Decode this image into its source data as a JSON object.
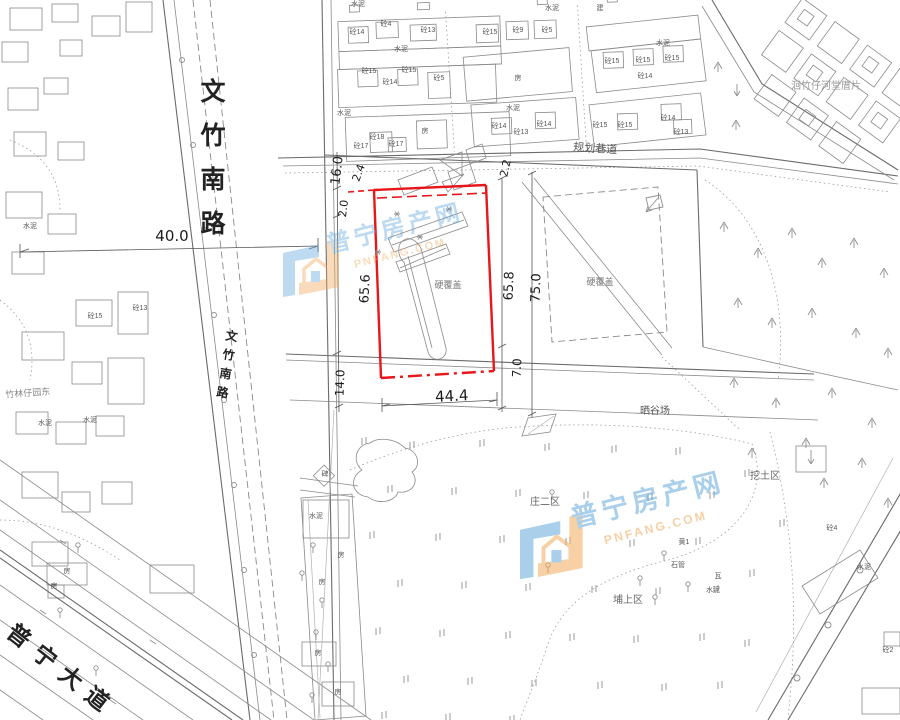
{
  "watermark": {
    "brand": "普宁房产网",
    "domain": "PNFANG.COM",
    "blue": "#63a9dc",
    "orange": "#f2ab5e"
  },
  "parcel": {
    "outline_color": "#e8151a",
    "label": "硬覆盖",
    "label_positions": [
      [
        448,
        288
      ],
      [
        600,
        285
      ]
    ]
  },
  "roads": {
    "wenzhu_south": "文竹南路",
    "puning_avenue": "普宁大道",
    "planned_road": "规划巷道"
  },
  "area_labels": [
    [
      "晒谷场",
      655,
      414,
      0,
      10,
      "#555"
    ],
    [
      "庄二区",
      545,
      505,
      0,
      10,
      "#666"
    ],
    [
      "埔上区",
      628,
      603,
      0,
      10,
      "#666"
    ],
    [
      "挖土区",
      765,
      479,
      0,
      10,
      "#666"
    ],
    [
      "洄竹仔河堂厝片",
      826,
      89,
      0,
      10,
      "#999"
    ],
    [
      "竹林仔园东",
      28,
      396,
      -4,
      9,
      "#888"
    ]
  ],
  "dimensions": [
    [
      "40.0",
      172,
      241,
      0,
      15
    ],
    [
      "44.4",
      452,
      401,
      -3,
      15
    ],
    [
      "16.0",
      341,
      171,
      -83,
      13
    ],
    [
      "2.4",
      362,
      174,
      -70,
      11
    ],
    [
      "2.0",
      347,
      209,
      -83,
      11
    ],
    [
      "2.2",
      509,
      169,
      -78,
      11
    ],
    [
      "65.6",
      369,
      289,
      -87,
      13
    ],
    [
      "65.8",
      513,
      286,
      -88,
      13
    ],
    [
      "75.0",
      540,
      288,
      -88,
      13
    ],
    [
      "7.0",
      521,
      368,
      -88,
      12
    ],
    [
      "14.0",
      344,
      383,
      -88,
      12
    ]
  ],
  "building_labels": [
    [
      "砼14",
      357,
      34
    ],
    [
      "砼4",
      386,
      26
    ],
    [
      "砼13",
      428,
      32
    ],
    [
      "水泥",
      401,
      51
    ],
    [
      "砼15",
      369,
      73
    ],
    [
      "砼15",
      409,
      72
    ],
    [
      "砼14",
      390,
      84
    ],
    [
      "砼5",
      439,
      80
    ],
    [
      "水泥",
      344,
      115
    ],
    [
      "砼18",
      377,
      139
    ],
    [
      "砼17",
      361,
      148
    ],
    [
      "砼17",
      396,
      146
    ],
    [
      "房",
      425,
      133
    ],
    [
      "砼15",
      490,
      34
    ],
    [
      "砼9",
      518,
      32
    ],
    [
      "砼5",
      547,
      32
    ],
    [
      "房",
      518,
      80
    ],
    [
      "水泥",
      513,
      110
    ],
    [
      "砼14",
      499,
      128
    ],
    [
      "砼13",
      521,
      134
    ],
    [
      "砼14",
      544,
      126
    ],
    [
      "水泥",
      663,
      45
    ],
    [
      "砼15",
      612,
      63
    ],
    [
      "砼15",
      643,
      62
    ],
    [
      "砼15",
      672,
      60
    ],
    [
      "砼14",
      645,
      78
    ],
    [
      "砼15",
      600,
      127
    ],
    [
      "砼15",
      625,
      127
    ],
    [
      "砼14",
      668,
      120
    ],
    [
      "砼13",
      681,
      134
    ],
    [
      "水泥",
      552,
      10
    ],
    [
      "建",
      600,
      10
    ],
    [
      "水泥",
      358,
      6
    ],
    [
      "砼4",
      832,
      530
    ],
    [
      "水泥",
      864,
      569
    ],
    [
      "砼2",
      888,
      652
    ],
    [
      "瓦",
      718,
      578
    ],
    [
      "水泥",
      713,
      592
    ],
    [
      "石管",
      678,
      567
    ],
    [
      "黄1",
      684,
      544
    ],
    [
      "水泥",
      316,
      518
    ],
    [
      "房",
      341,
      557
    ],
    [
      "房",
      322,
      584
    ],
    [
      "房",
      318,
      655
    ],
    [
      "房",
      338,
      694
    ],
    [
      "房",
      67,
      573
    ],
    [
      "房",
      54,
      588
    ],
    [
      "碑",
      325,
      476
    ],
    [
      "水泥",
      30,
      228
    ],
    [
      "水泥",
      90,
      422
    ],
    [
      "水泥",
      45,
      425
    ],
    [
      "砼15",
      95,
      318
    ],
    [
      "砼13",
      140,
      310
    ]
  ],
  "symbols": {
    "paddy": [
      [
        362,
        438
      ],
      [
        410,
        442
      ],
      [
        480,
        440
      ],
      [
        545,
        444
      ],
      [
        612,
        446
      ],
      [
        676,
        448
      ],
      [
        388,
        486
      ],
      [
        452,
        488
      ],
      [
        516,
        490
      ],
      [
        584,
        492
      ],
      [
        648,
        494
      ],
      [
        710,
        492
      ],
      [
        370,
        532
      ],
      [
        436,
        534
      ],
      [
        500,
        536
      ],
      [
        566,
        538
      ],
      [
        630,
        540
      ],
      [
        696,
        538
      ],
      [
        398,
        580
      ],
      [
        462,
        582
      ],
      [
        526,
        584
      ],
      [
        592,
        586
      ],
      [
        656,
        588
      ],
      [
        714,
        586
      ],
      [
        376,
        628
      ],
      [
        440,
        630
      ],
      [
        506,
        632
      ],
      [
        570,
        634
      ],
      [
        634,
        636
      ],
      [
        700,
        634
      ],
      [
        404,
        676
      ],
      [
        468,
        678
      ],
      [
        532,
        680
      ],
      [
        598,
        682
      ],
      [
        662,
        684
      ],
      [
        718,
        682
      ],
      [
        382,
        712
      ],
      [
        446,
        714
      ],
      [
        510,
        716
      ],
      [
        745,
        470
      ],
      [
        780,
        520
      ],
      [
        750,
        570
      ],
      [
        745,
        640
      ]
    ],
    "trees": [
      [
        724,
        222
      ],
      [
        758,
        248
      ],
      [
        792,
        228
      ],
      [
        822,
        258
      ],
      [
        854,
        238
      ],
      [
        884,
        268
      ],
      [
        738,
        298
      ],
      [
        772,
        318
      ],
      [
        812,
        308
      ],
      [
        856,
        328
      ],
      [
        888,
        348
      ],
      [
        734,
        378
      ],
      [
        776,
        398
      ],
      [
        832,
        388
      ],
      [
        872,
        418
      ],
      [
        752,
        448
      ],
      [
        806,
        438
      ],
      [
        862,
        458
      ],
      [
        888,
        498
      ],
      [
        824,
        478
      ],
      [
        718,
        62
      ],
      [
        736,
        120
      ]
    ],
    "pins": [
      [
        313,
        545
      ],
      [
        302,
        573
      ],
      [
        322,
        600
      ],
      [
        316,
        632
      ],
      [
        328,
        664
      ],
      [
        312,
        695
      ],
      [
        552,
        492
      ],
      [
        548,
        565
      ],
      [
        640,
        578
      ],
      [
        664,
        553
      ],
      [
        655,
        597
      ],
      [
        688,
        584
      ],
      [
        78,
        545
      ],
      [
        60,
        610
      ],
      [
        96,
        668
      ]
    ],
    "stars": [
      [
        397,
        214
      ],
      [
        420,
        237
      ],
      [
        378,
        252
      ],
      [
        449,
        209
      ]
    ]
  }
}
